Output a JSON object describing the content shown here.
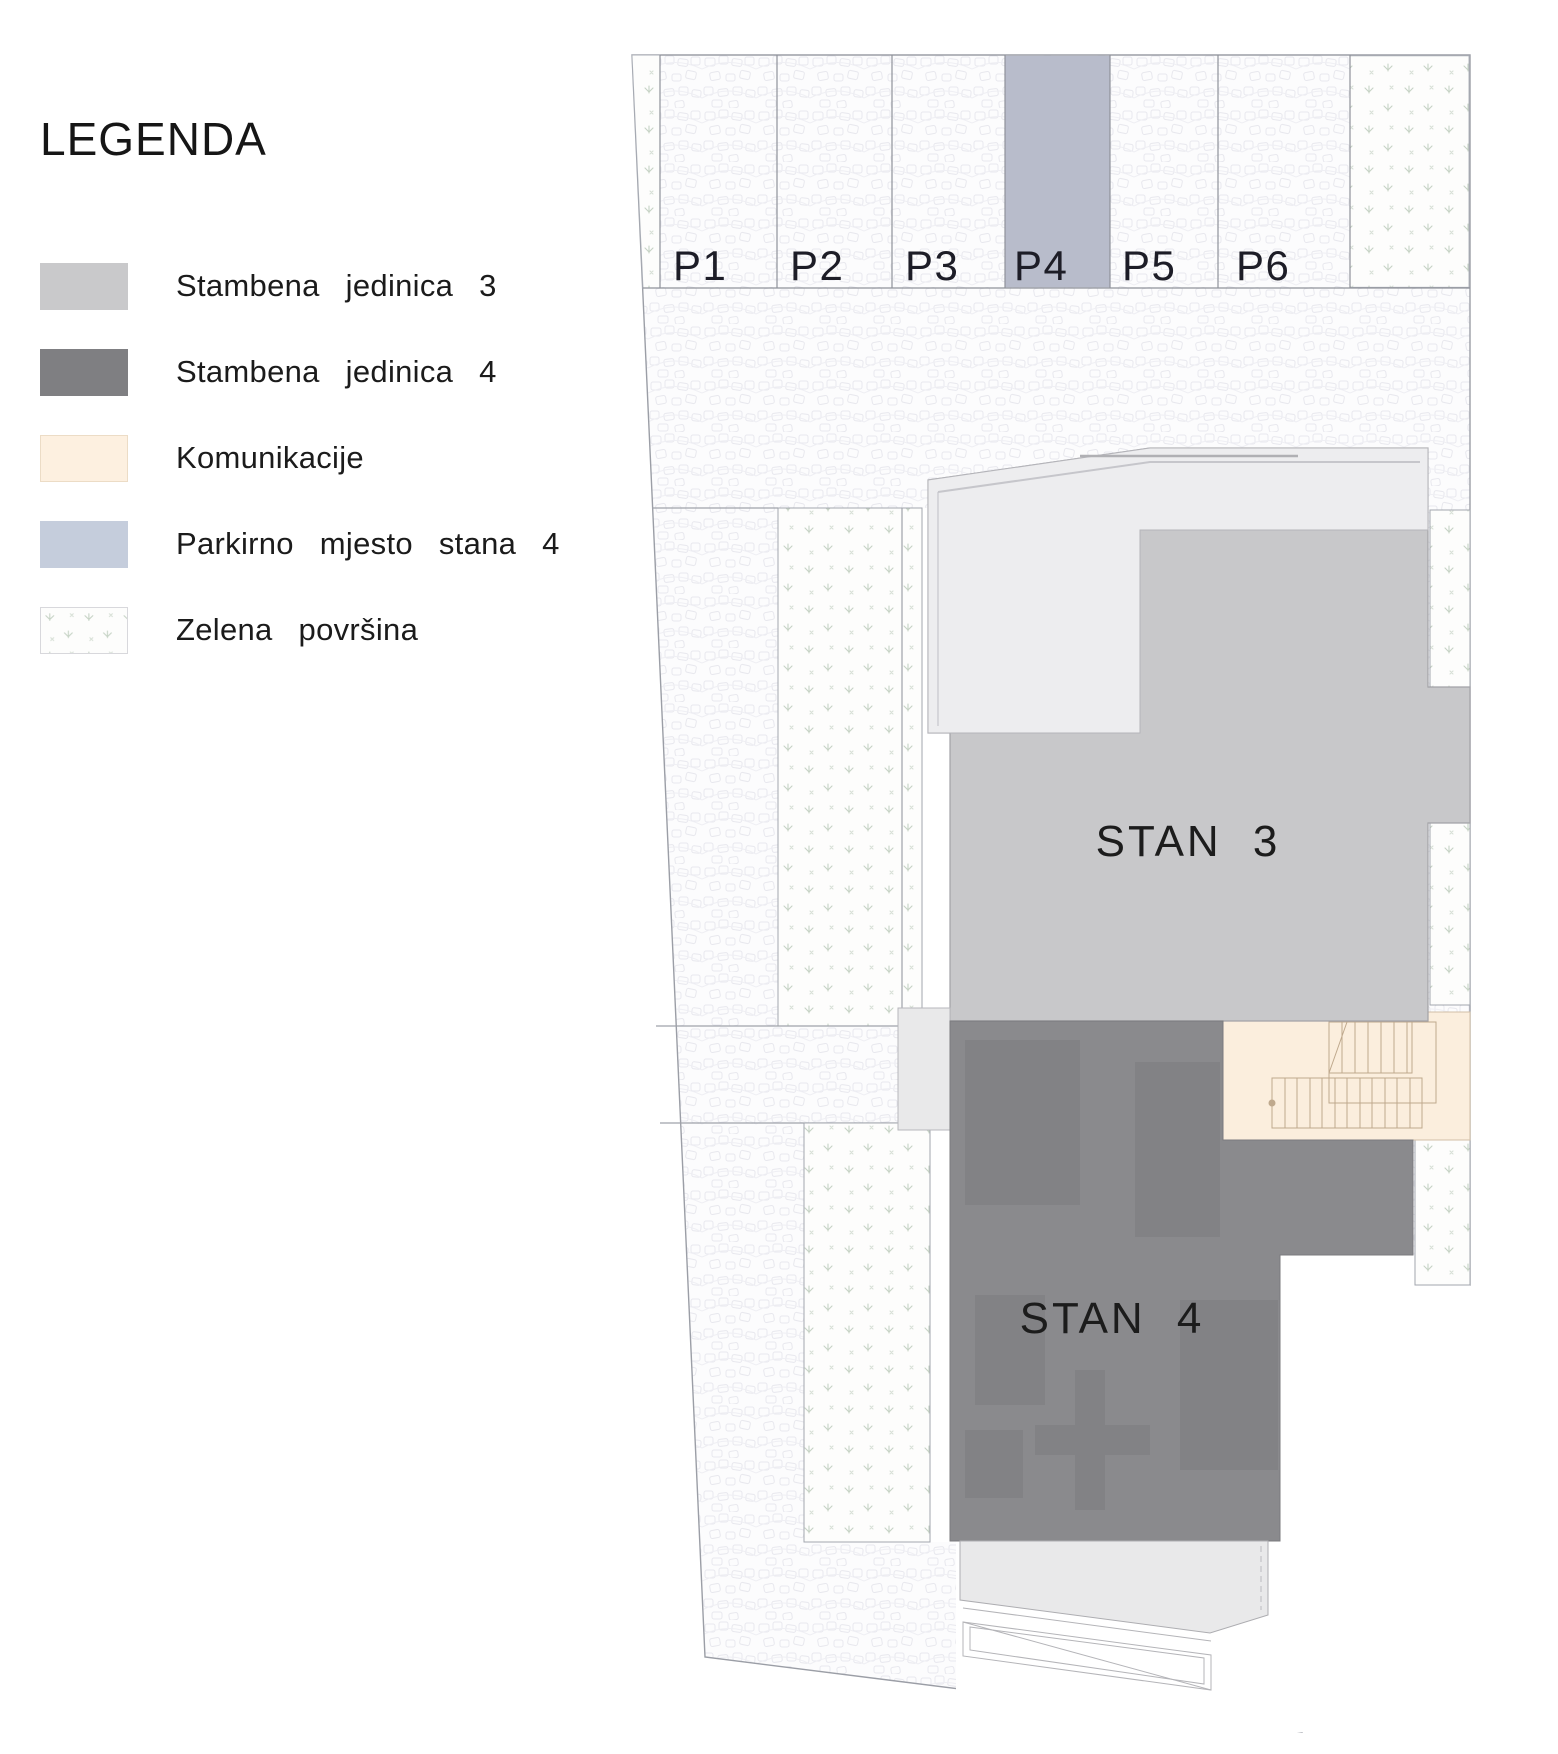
{
  "legend": {
    "title": "LEGENDA",
    "items": [
      {
        "key": "stambena-3",
        "label": "Stambena jedinica 3",
        "color": "#c9c9cb"
      },
      {
        "key": "stambena-4",
        "label": "Stambena jedinica 4",
        "color": "#7f7f82"
      },
      {
        "key": "komunikacije",
        "label": "Komunikacije",
        "color": "#fdf0e0"
      },
      {
        "key": "parkirno-4",
        "label": "Parkirno mjesto stana 4",
        "color": "#c5cddc"
      },
      {
        "key": "zelena",
        "label": "Zelena površina",
        "color": "#f4f8f2"
      }
    ]
  },
  "plan": {
    "parking": {
      "stalls": [
        {
          "label": "P1",
          "highlighted": false
        },
        {
          "label": "P2",
          "highlighted": false
        },
        {
          "label": "P3",
          "highlighted": false
        },
        {
          "label": "P4",
          "highlighted": true
        },
        {
          "label": "P5",
          "highlighted": false
        },
        {
          "label": "P6",
          "highlighted": false
        }
      ]
    },
    "units": {
      "stan3": {
        "label": "STAN 3"
      },
      "stan4": {
        "label": "STAN 4"
      }
    },
    "colors": {
      "stan3": "#c8c8ca",
      "stan3_terrace": "#ededef",
      "stan4": "#8a8a8d",
      "stan4_inner": "#828285",
      "komunikacije": "#fbeedd",
      "parking_highlight": "#b8bccb",
      "bottom_terrace": "#e9e9ea",
      "porch": "#e9e9ea"
    }
  }
}
